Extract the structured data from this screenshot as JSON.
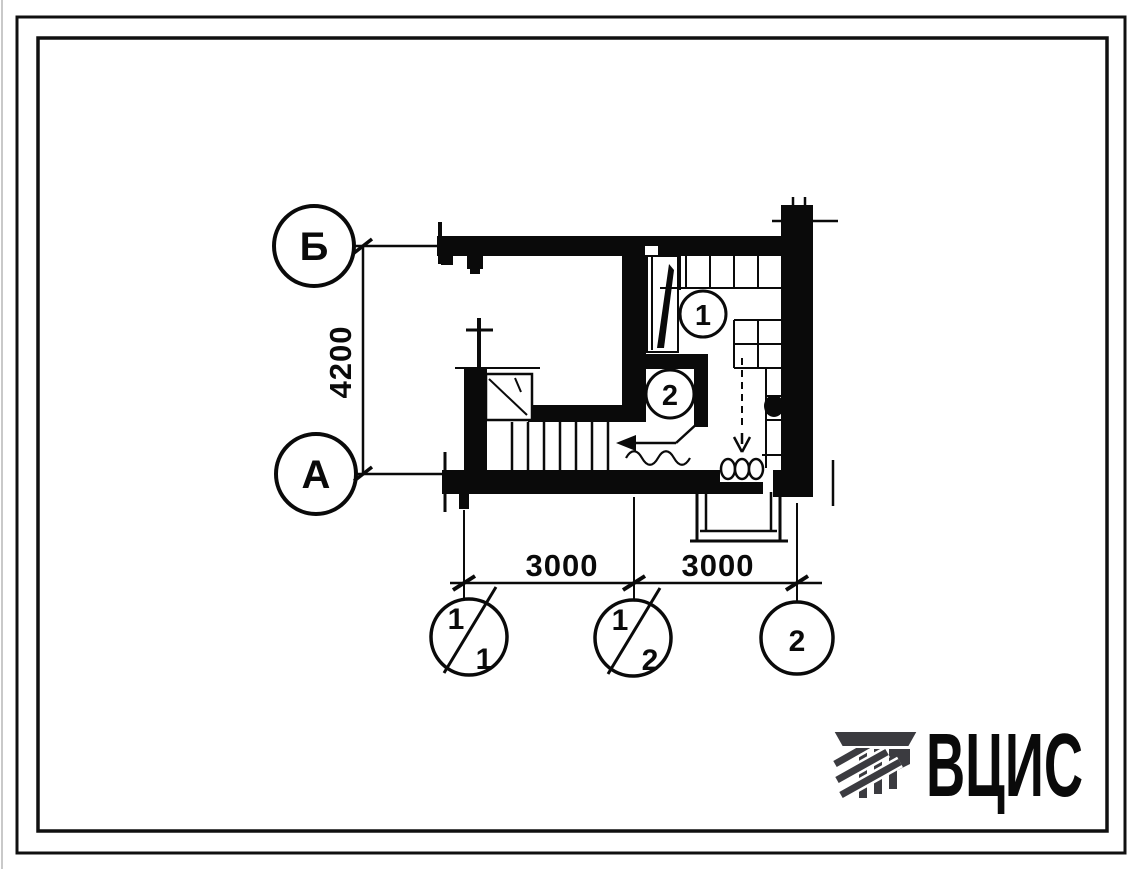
{
  "plan": {
    "axis_left": {
      "top_label": "Б",
      "bottom_label": "А"
    },
    "axis_bottom": {
      "left": {
        "numerator": "1",
        "denominator": "1"
      },
      "middle": {
        "numerator": "1",
        "denominator": "2"
      },
      "right": {
        "label": "2"
      }
    },
    "dimensions": {
      "vertical": "4200",
      "bottom_left": "3000",
      "bottom_right": "3000"
    },
    "rooms": {
      "room1": "1",
      "room2": "2"
    }
  },
  "logo": {
    "text": "ВЦИС",
    "color": "#3b3b40"
  },
  "colors": {
    "ink": "#0a0a0a",
    "paper": "#ffffff",
    "edge_artifact": "#c9c9c9"
  }
}
